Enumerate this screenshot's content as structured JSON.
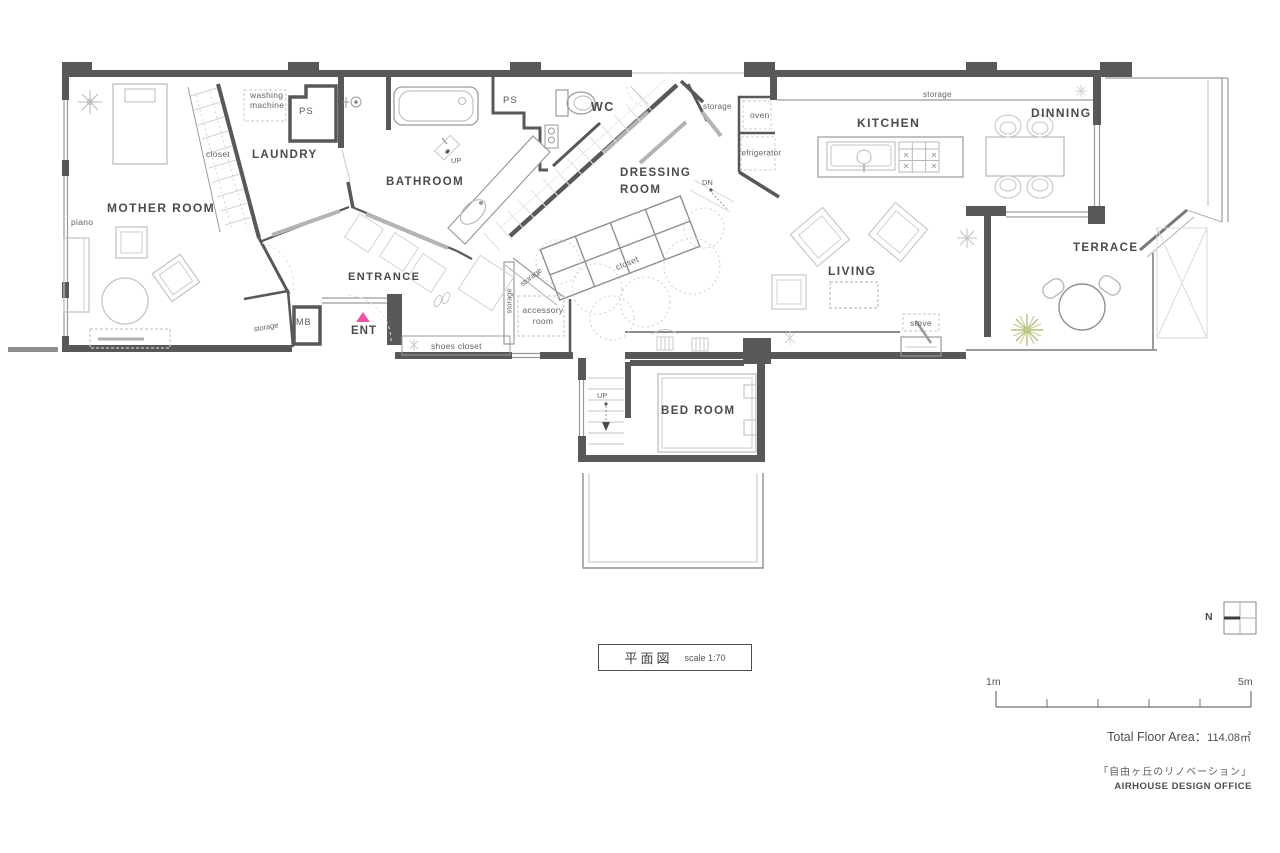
{
  "colors": {
    "wall_dark": "#58585a",
    "accent_pink": "#ee55a8",
    "plant_green": "#a9b464",
    "furniture_gray": "#c4c4c6"
  },
  "rooms": {
    "mother_room": "MOTHER ROOM",
    "laundry": "LAUNDRY",
    "bathroom": "BATHROOM",
    "wc": "WC",
    "dressing_line1": "DRESSING",
    "dressing_line2": "ROOM",
    "kitchen": "KITCHEN",
    "dinning": "DINNING",
    "living": "LIVING",
    "terrace": "TERRACE",
    "bed_room": "BED ROOM",
    "entrance": "ENTRANCE",
    "ent": "ENT"
  },
  "features": {
    "washing_line1": "washing",
    "washing_line2": "machine",
    "ps_top": "PS",
    "ps_wc": "PS",
    "closet_mother": "closet",
    "closet_dressing": "closet",
    "piano": "piano",
    "storage_wc": "storage",
    "storage_kitchen": "storage",
    "storage_mother": "storage",
    "storage_hall_diag": "storage",
    "storage_hall_vert": "storage",
    "accessory_line1": "accessory",
    "accessory_line2": "room",
    "shoes_closet": "shoes closet",
    "mb": "MB",
    "oven": "oven",
    "refrigerator": "refrigerator",
    "stove": "stove",
    "up_bathroom": "UP",
    "up_stairs": "UP",
    "dn": "DN"
  },
  "legend": {
    "drawing_title": "平面図",
    "scale_note": "scale 1:70",
    "north": "N",
    "scalebar_start": "1m",
    "scalebar_end": "5m",
    "total_area_label": "Total Floor Area：",
    "total_area_value": "114.08㎡",
    "project_title": "「自由ヶ丘のリノベーション」",
    "office": "AIRHOUSE DESIGN OFFICE"
  }
}
